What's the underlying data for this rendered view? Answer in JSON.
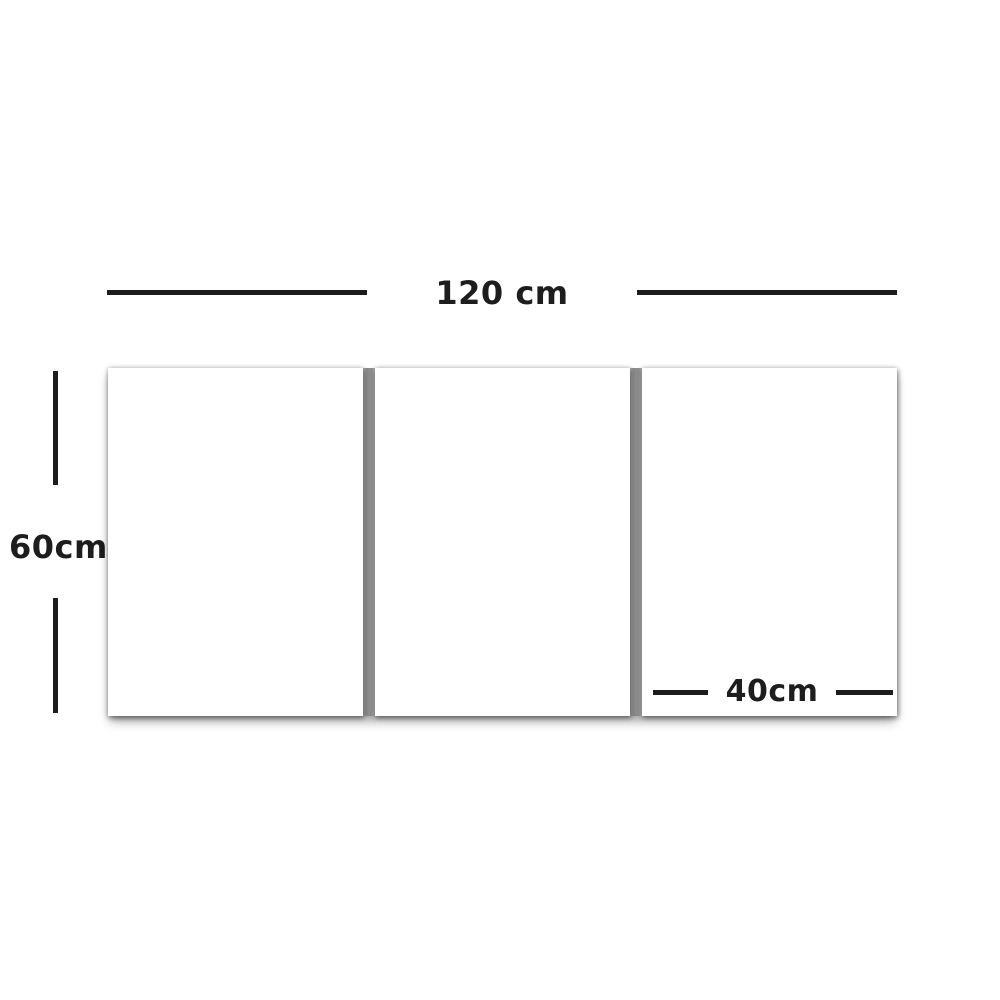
{
  "diagram": {
    "panel_count": 3,
    "total_width": {
      "label": "120 cm"
    },
    "height": {
      "label": "60cm"
    },
    "panel_width": {
      "label": "40cm"
    }
  },
  "colors": {
    "background": "#ffffff",
    "panel_fill": "#ffffff",
    "dimension_line": "#1d1d1d",
    "label_text": "#1d1d1d",
    "divider": "#8d8d8d",
    "shadow": "rgba(0,0,0,0.38)"
  }
}
